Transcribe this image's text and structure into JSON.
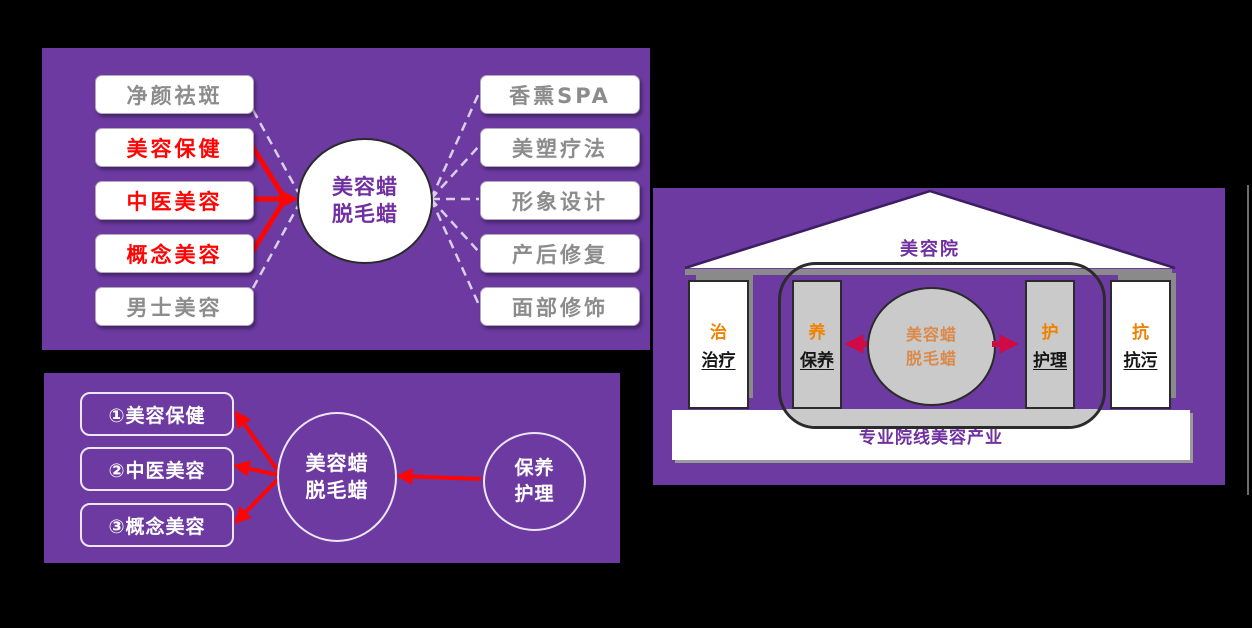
{
  "colors": {
    "background": "#000000",
    "panel_purple": "#6C3AA0",
    "highlight_red": "#FE0505",
    "crimson_arrow": "#D00A45",
    "orange_accent": "#F08200",
    "node_purple_text": "#7030A0",
    "muted_orange_text": "#DB8A4A",
    "gray_text": "#8C8C8C",
    "gray_fill": "#CACACA",
    "dashed_line": "#D9CFEA"
  },
  "applications_panel": {
    "center_node": {
      "line1": "美容蜡",
      "line2": "脱毛蜡"
    },
    "left_items": [
      {
        "label": "净颜祛斑",
        "highlighted": false
      },
      {
        "label": "美容保健",
        "highlighted": true
      },
      {
        "label": "中医美容",
        "highlighted": true
      },
      {
        "label": "概念美容",
        "highlighted": true
      },
      {
        "label": "男士美容",
        "highlighted": false
      }
    ],
    "right_items": [
      {
        "label": "香熏SPA"
      },
      {
        "label": "美塑疗法"
      },
      {
        "label": "形象设计"
      },
      {
        "label": "产后修复"
      },
      {
        "label": "面部修饰"
      }
    ]
  },
  "priority_panel": {
    "items": [
      {
        "label": "①美容保健"
      },
      {
        "label": "②中医美容"
      },
      {
        "label": "③概念美容"
      }
    ],
    "center_node": {
      "line1": "美容蜡",
      "line2": "脱毛蜡"
    },
    "support_node": {
      "line1": "保养",
      "line2": "护理"
    }
  },
  "temple_panel": {
    "roof_label": "美容院",
    "base_label": "专业院线美容产业",
    "center_node": {
      "line1": "美容蜡",
      "line2": "脱毛蜡"
    },
    "pillars": [
      {
        "initial": "治",
        "word": "治疗"
      },
      {
        "initial": "养",
        "word": "保养"
      },
      {
        "initial": "护",
        "word": "护理"
      },
      {
        "initial": "抗",
        "word": "抗污"
      }
    ]
  }
}
